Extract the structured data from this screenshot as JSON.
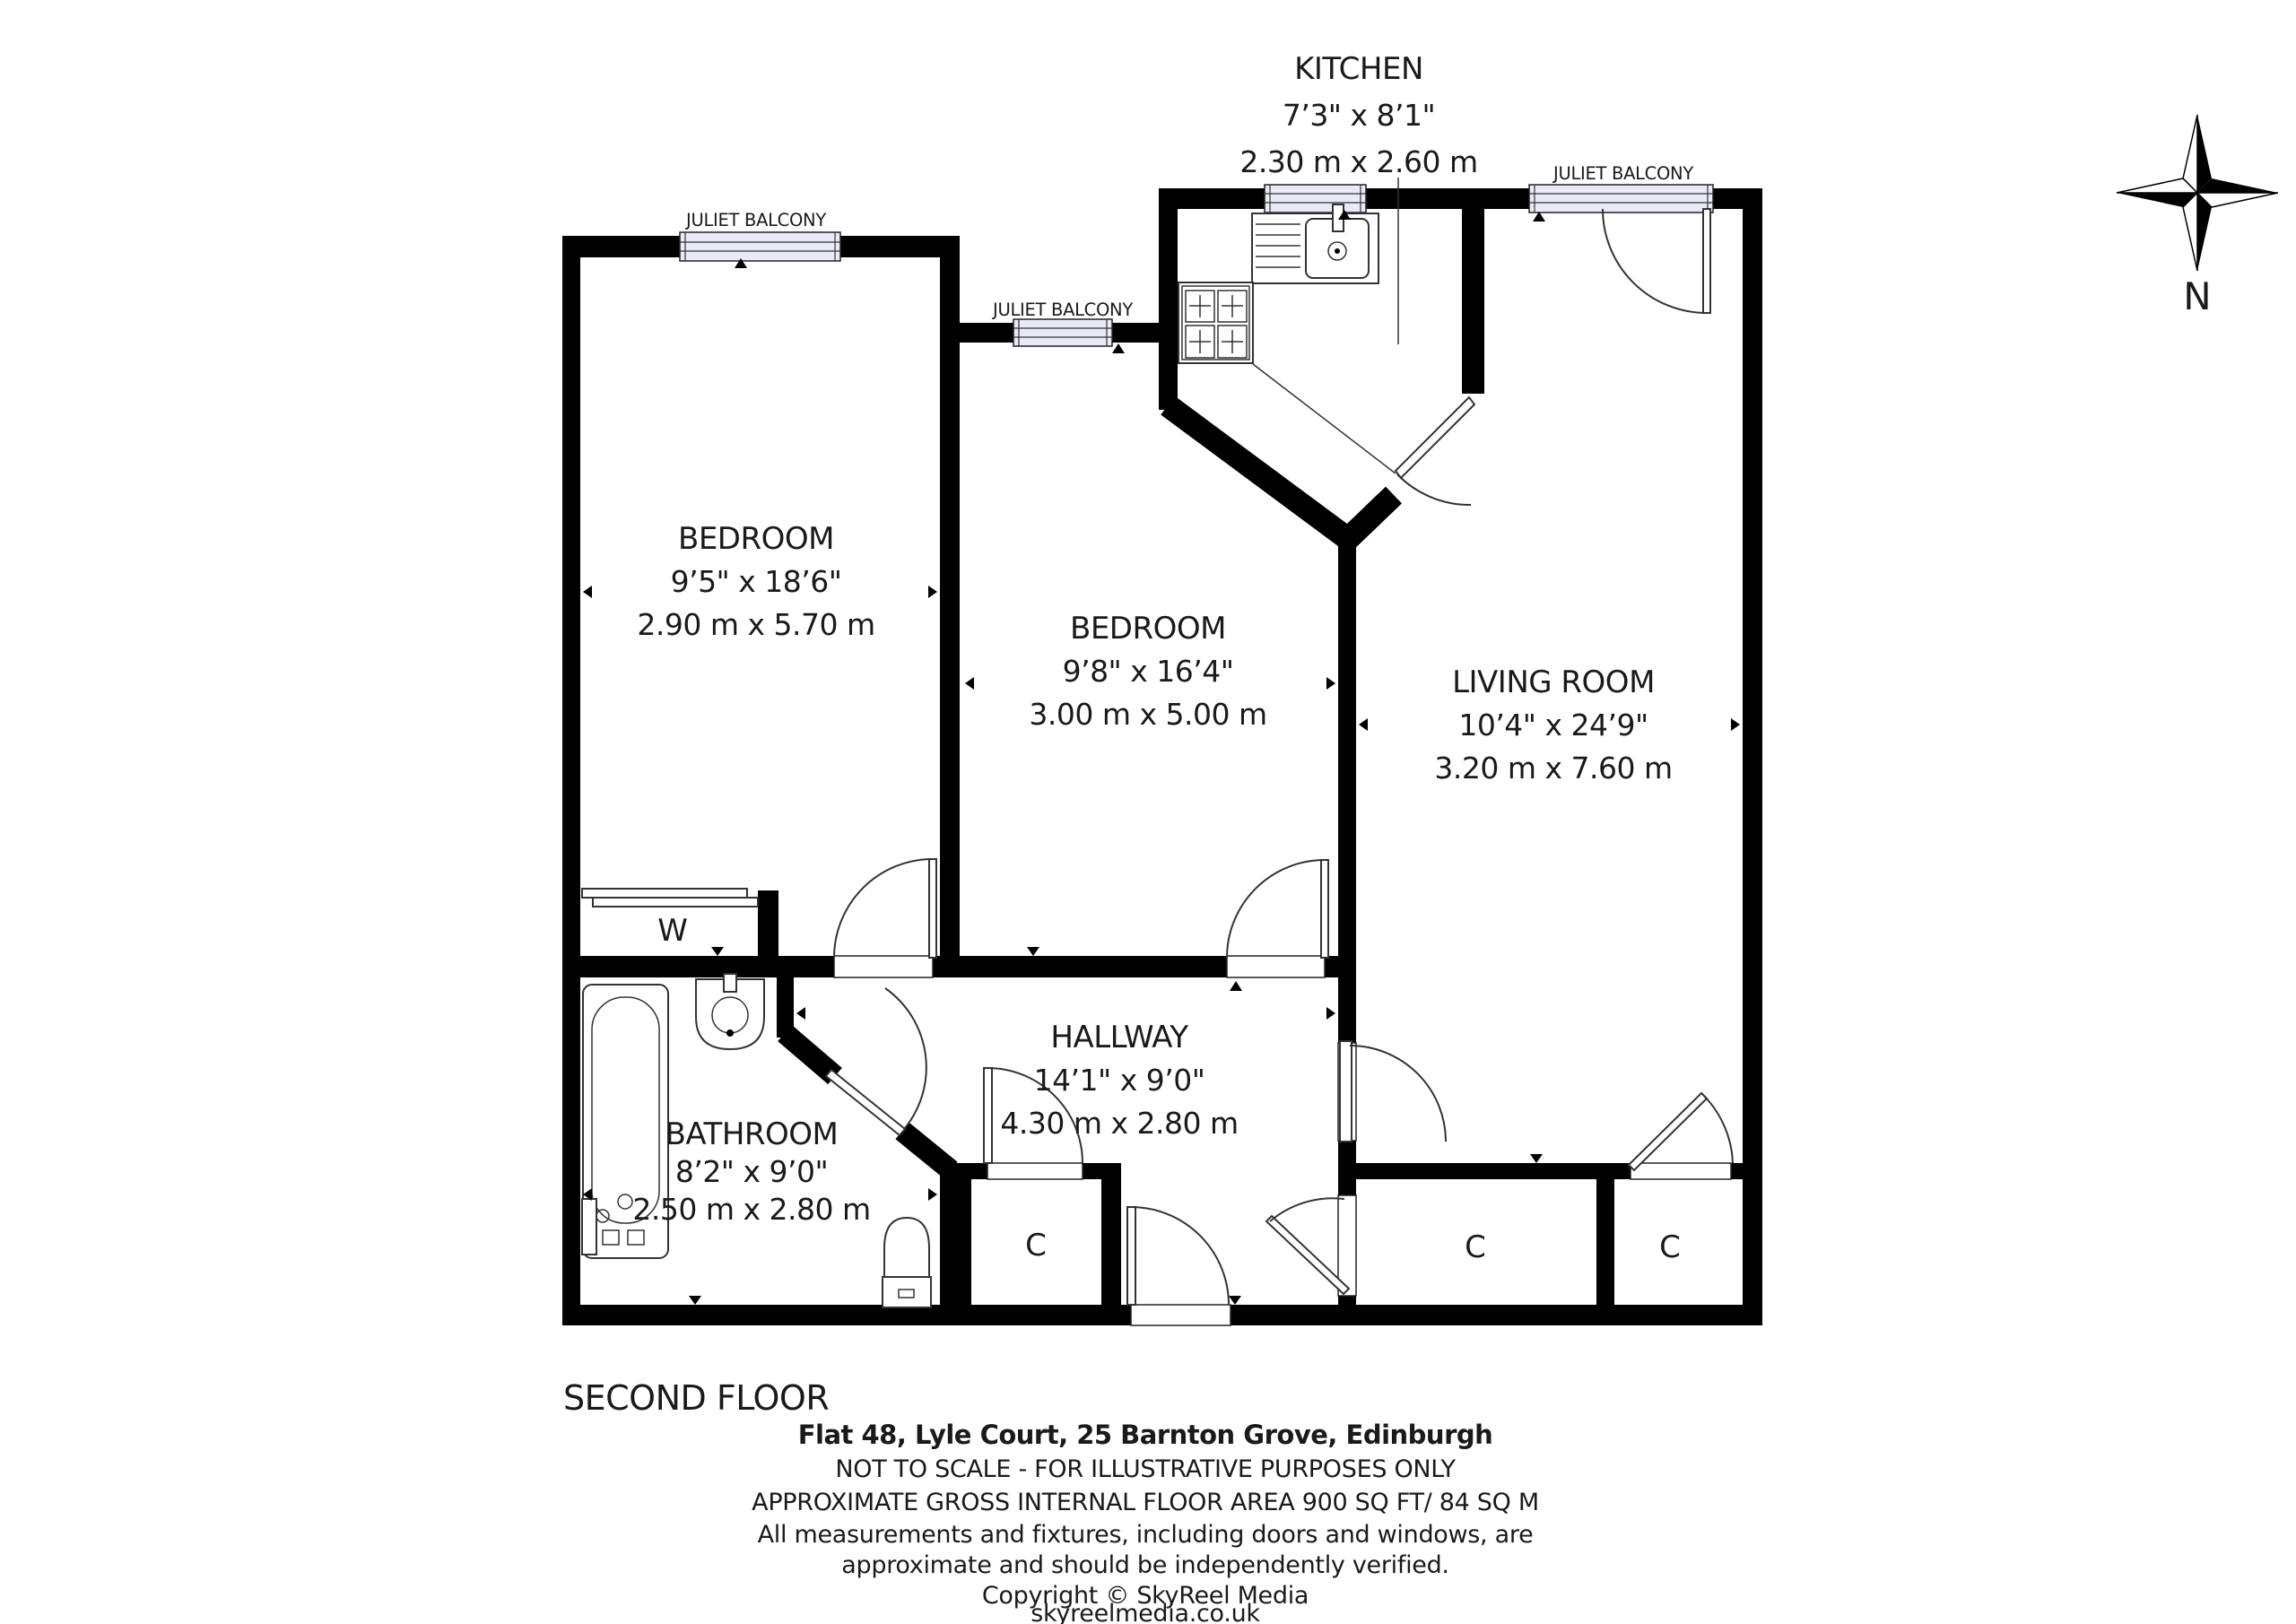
{
  "plan": {
    "floor_label": "SECOND FLOOR",
    "compass_label": "N",
    "juliet_balcony": "JULIET BALCONY",
    "wardrobe_label": "W",
    "cupboard_label": "C",
    "rooms": {
      "kitchen": {
        "name": "KITCHEN",
        "imperial": "7’3\" x 8’1\"",
        "metric": "2.30 m x 2.60 m"
      },
      "bedroom1": {
        "name": "BEDROOM",
        "imperial": "9’5\" x 18’6\"",
        "metric": "2.90 m x 5.70 m"
      },
      "bedroom2": {
        "name": "BEDROOM",
        "imperial": "9’8\" x 16’4\"",
        "metric": "3.00 m x 5.00 m"
      },
      "living_room": {
        "name": "LIVING ROOM",
        "imperial": "10’4\" x 24’9\"",
        "metric": "3.20 m x 7.60 m"
      },
      "hallway": {
        "name": "HALLWAY",
        "imperial": "14’1\" x 9’0\"",
        "metric": "4.30 m x 2.80 m"
      },
      "bathroom": {
        "name": "BATHROOM",
        "imperial": "8’2\" x 9’0\"",
        "metric": "2.50 m x 2.80 m"
      }
    },
    "footer": {
      "address": "Flat 48, Lyle Court, 25 Barnton Grove, Edinburgh",
      "disclaimer1": "NOT TO SCALE - FOR ILLUSTRATIVE PURPOSES ONLY",
      "area": "APPROXIMATE GROSS INTERNAL FLOOR AREA 900 SQ FT/ 84 SQ M",
      "disclaimer2": "All measurements and fixtures, including doors and windows, are",
      "disclaimer3": "approximate and should be independently verified.",
      "copyright": "Copyright © SkyReel Media",
      "website": "skyreelmedia.co.uk"
    },
    "colors": {
      "wall": "#000000",
      "window_fill": "#e9e9f7",
      "text": "#1a1a1a"
    }
  }
}
